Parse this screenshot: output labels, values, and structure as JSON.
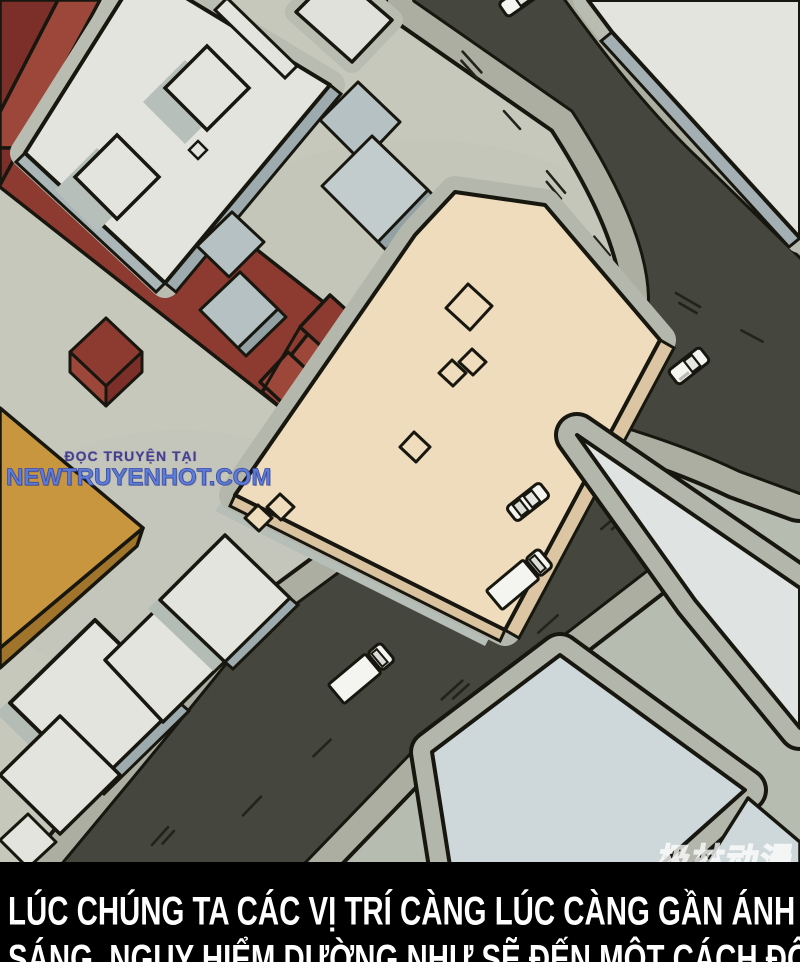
{
  "panel": {
    "type": "manga-panel-isometric-city-aerial-view",
    "watermark": {
      "line1": "ĐỌC TRUYỆN TẠI",
      "line2": "NEWTRUYENHOT.COM",
      "line1_color": "#453f91",
      "line2_color": "#5d7ed6"
    },
    "caption": {
      "line1": "LÚC CHÚNG TA CÁC VỊ TRÍ CÀNG LÚC CÀNG GẦN ÁNH",
      "line2_partial": "SÁNG, NGUY HIỂM DƯỜNG NHƯ SẼ ĐẾN MỘT CÁCH ĐỘT NGỘT",
      "text_color": "#ffffff",
      "bar_color": "#000000"
    },
    "corner_logo": {
      "text": "极林动漫"
    },
    "scene": {
      "vehicle_count": 5,
      "vehicles": [
        "car-partial-top",
        "car-east-road",
        "car-southwest-road",
        "box-truck-1",
        "box-truck-2"
      ]
    },
    "palette": {
      "ground": "#c6c8bc",
      "road": "#45463d",
      "sidewalk": "#acaea1",
      "outline": "#17170f",
      "building_white": "#e3e4dd",
      "building_side_gray": "#9dabae",
      "building_blue_gray": "#b6c1c3",
      "building_pale_blue": "#ced7da",
      "building_red_top": "#7c2f28",
      "building_red_mid": "#8d3a31",
      "building_red_light": "#9d473b",
      "building_ochre": "#c8963f",
      "building_ochre_side": "#a0742b",
      "building_cream": "#eedcbc",
      "building_cream_side": "#dbc5a2",
      "vehicle_white": "#f4f4f0"
    }
  }
}
